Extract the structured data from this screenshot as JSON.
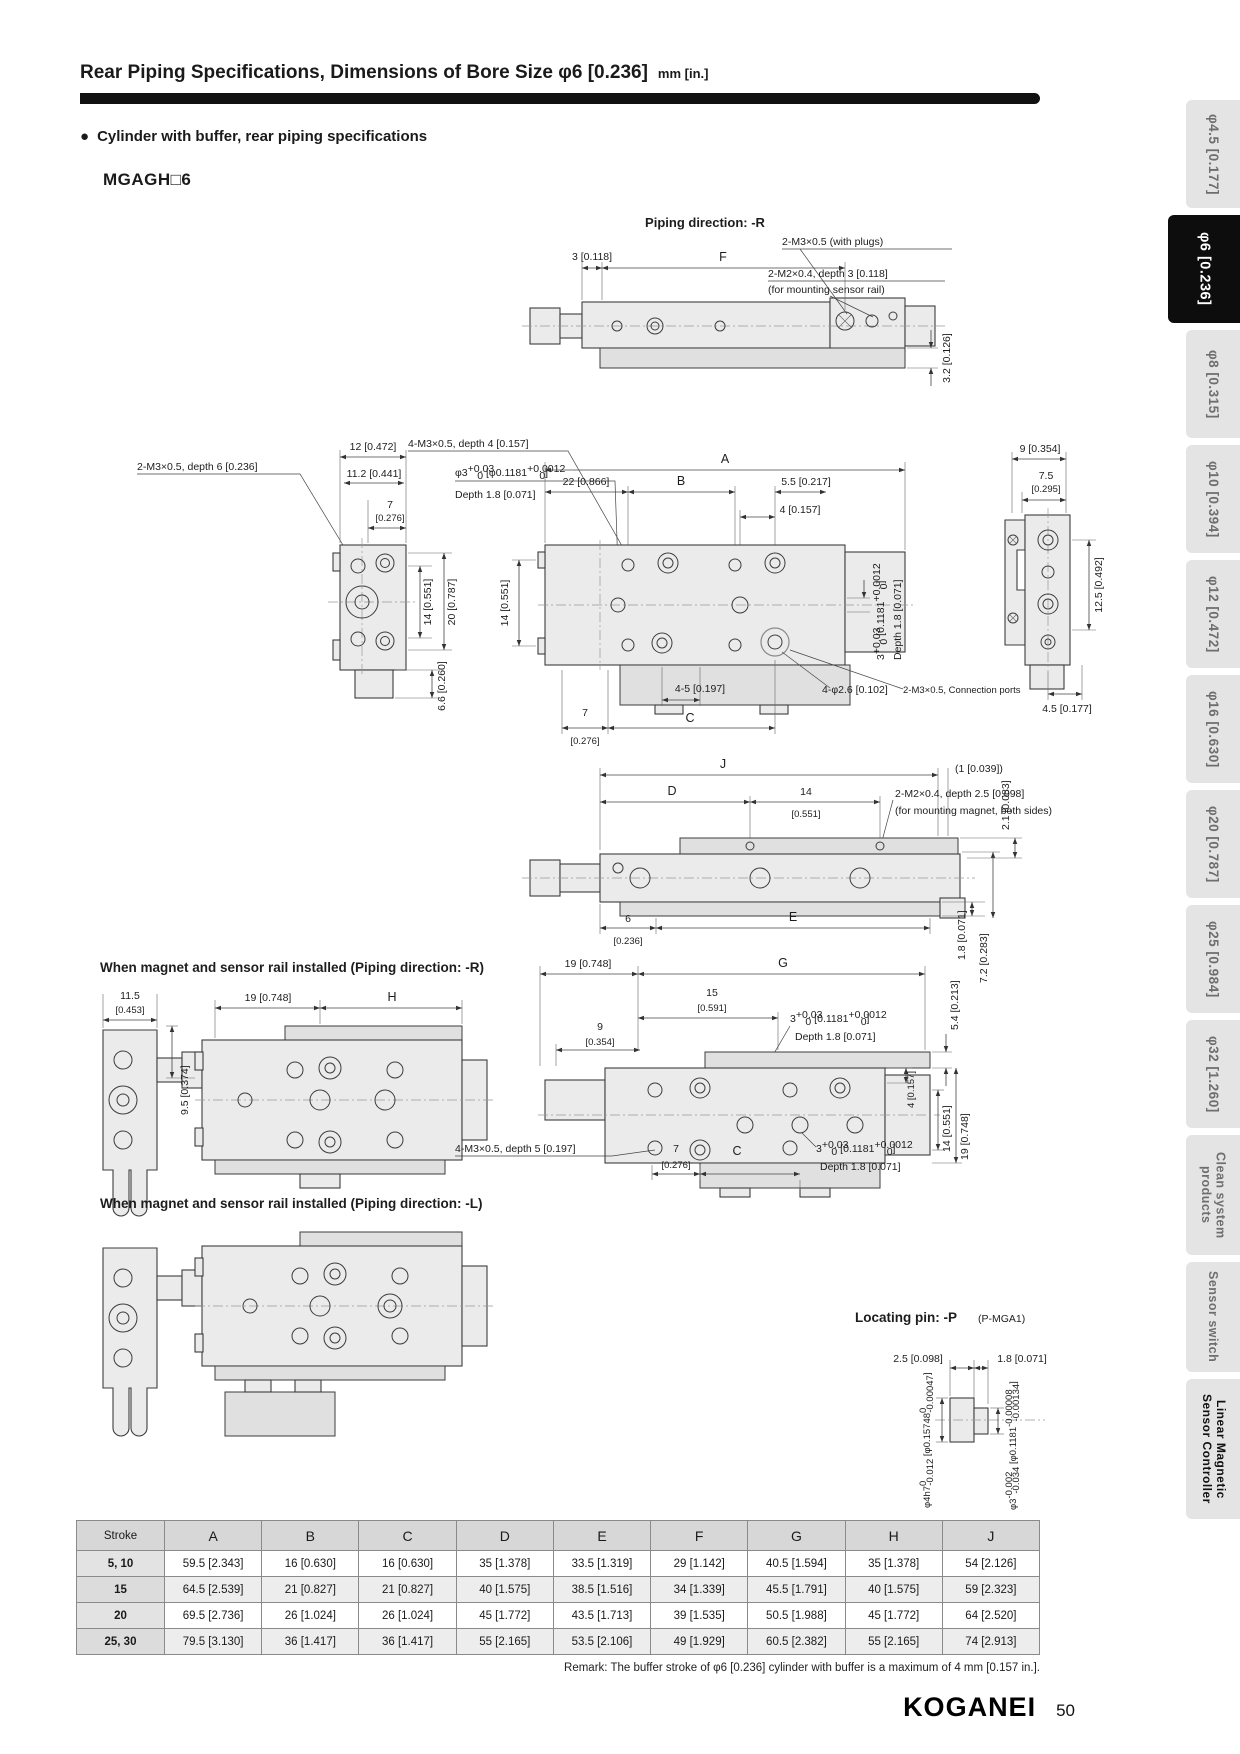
{
  "page": {
    "title": "Rear Piping Specifications, Dimensions of Bore Size φ6 [0.236]",
    "unit": "mm [in.]",
    "bullet": "Cylinder with buffer, rear piping specifications",
    "model": "MGAGH□6",
    "remark": "Remark: The buffer stroke of φ6 [0.236] cylinder with buffer is a maximum of 4 mm [0.157 in.].",
    "logo": "KOGANEI",
    "page_number": "50"
  },
  "sidebar": {
    "tabs": [
      {
        "label": "φ4.5 [0.177]",
        "active": false
      },
      {
        "label": "φ6 [0.236]",
        "active": true
      },
      {
        "label": "φ8 [0.315]",
        "active": false
      },
      {
        "label": "φ10 [0.394]",
        "active": false
      },
      {
        "label": "φ12 [0.472]",
        "active": false
      },
      {
        "label": "φ16 [0.630]",
        "active": false
      },
      {
        "label": "φ20 [0.787]",
        "active": false
      },
      {
        "label": "φ25 [0.984]",
        "active": false
      },
      {
        "label": "φ32 [1.260]",
        "active": false
      },
      {
        "label": "Clean system products",
        "active": false
      },
      {
        "label": "Sensor switch",
        "active": false
      },
      {
        "label": "Linear Magnetic Sensor Controller",
        "active": false
      }
    ]
  },
  "d": {
    "piping_title": "Piping direction: -R",
    "plugs": "2-M3×0.5 (with plugs)",
    "m2_d3": "2-M2×0.4, depth 3 [0.118]",
    "rail_note": "(for mounting sensor rail)",
    "d3_118": "3 [0.118]",
    "F": "F",
    "d3_2": "3.2 [0.126]",
    "m3_d6": "2-M3×0.5, depth 6 [0.236]",
    "d12": "12 [0.472]",
    "d11_2": "11.2 [0.441]",
    "d7": "7",
    "in276": "[0.276]",
    "m3_d4": "4-M3×0.5, depth 4 [0.157]",
    "depth18": "Depth 1.8 [0.071]",
    "d14": "14 [0.551]",
    "d20": "20 [0.787]",
    "d6_6": "6.6 [0.260]",
    "A": "A",
    "B": "B",
    "C": "C",
    "d22": "22 [0.866]",
    "d5_5": "5.5 [0.217]",
    "d4": "4 [0.157]",
    "d45h": "4-5 [0.197]",
    "phi26": "4-φ2.6 [0.102]",
    "conn": "2-M3×0.5, Connection ports",
    "d9": "9 [0.354]",
    "d7_5": "7.5",
    "in295": "[0.295]",
    "d12_5": "12.5 [0.492]",
    "d4_5": "4.5 [0.177]",
    "J": "J",
    "D": "D",
    "E": "E",
    "H": "H",
    "G": "G",
    "d14a": "14",
    "in551": "[0.551]",
    "par1": "(1 [0.039])",
    "m2_d25": "2-M2×0.4, depth 2.5 [0.098]",
    "mag_note": "(for mounting magnet, both sides)",
    "d6": "6",
    "in236": "[0.236]",
    "d1_8": "1.8 [0.071]",
    "d7_2": "7.2 [0.283]",
    "d2_1": "2.1 [0.083]",
    "inst_r": "When magnet and sensor rail installed (Piping direction: -R)",
    "inst_l": "When magnet and sensor rail installed (Piping direction: -L)",
    "d11_5": "11.5",
    "in453": "[0.453]",
    "d19": "19 [0.748]",
    "d9_5": "9.5 [0.374]",
    "d15": "15",
    "in591": "[0.591]",
    "d9b": "9",
    "in354": "[0.354]",
    "d5_4": "5.4 [0.213]",
    "m3_d5": "4-M3×0.5, depth 5 [0.197]",
    "loc_b": "Locating pin: -P",
    "loc_r": "(P-MGA1)",
    "d2_5": "2.5 [0.098]",
    "d1_8b": "1.8 [0.071]"
  },
  "tol": {
    "phi3": {
      "base": "φ3",
      "sup": "+0.03",
      "sub": "0",
      "mid": " [φ0.1181",
      "sup2": "+0.0012",
      "sub2": "0",
      "end": "]"
    },
    "t3": {
      "base": "3",
      "sup": "+0.03",
      "sub": "0",
      "mid": " [0.1181",
      "sup2": "+0.0012",
      "sub2": "0",
      "end": "]"
    },
    "pin_l": {
      "base": "φ4h7",
      "sup": "0",
      "sub": "-0.012",
      "mid": " [φ0.15748",
      "sup2": "0",
      "sub2": "-0.00047",
      "end": "]"
    },
    "pin_r": {
      "base": "φ3",
      "sup": "-0.002",
      "sub": "-0.034",
      "mid": " [φ0.1181",
      "sup2": "-0.00008",
      "sub2": "-0.00134",
      "end": "]"
    }
  },
  "table": {
    "headers": [
      "Stroke",
      "A",
      "B",
      "C",
      "D",
      "E",
      "F",
      "G",
      "H",
      "J"
    ],
    "rows": [
      [
        "5, 10",
        "59.5 [2.343]",
        "16 [0.630]",
        "16 [0.630]",
        "35 [1.378]",
        "33.5 [1.319]",
        "29 [1.142]",
        "40.5 [1.594]",
        "35 [1.378]",
        "54 [2.126]"
      ],
      [
        "15",
        "64.5 [2.539]",
        "21 [0.827]",
        "21 [0.827]",
        "40 [1.575]",
        "38.5 [1.516]",
        "34 [1.339]",
        "45.5 [1.791]",
        "40 [1.575]",
        "59 [2.323]"
      ],
      [
        "20",
        "69.5 [2.736]",
        "26 [1.024]",
        "26 [1.024]",
        "45 [1.772]",
        "43.5 [1.713]",
        "39 [1.535]",
        "50.5 [1.988]",
        "45 [1.772]",
        "64 [2.520]"
      ],
      [
        "25, 30",
        "79.5 [3.130]",
        "36 [1.417]",
        "36 [1.417]",
        "55 [2.165]",
        "53.5 [2.106]",
        "49 [1.929]",
        "60.5 [2.382]",
        "55 [2.165]",
        "74 [2.913]"
      ]
    ]
  }
}
